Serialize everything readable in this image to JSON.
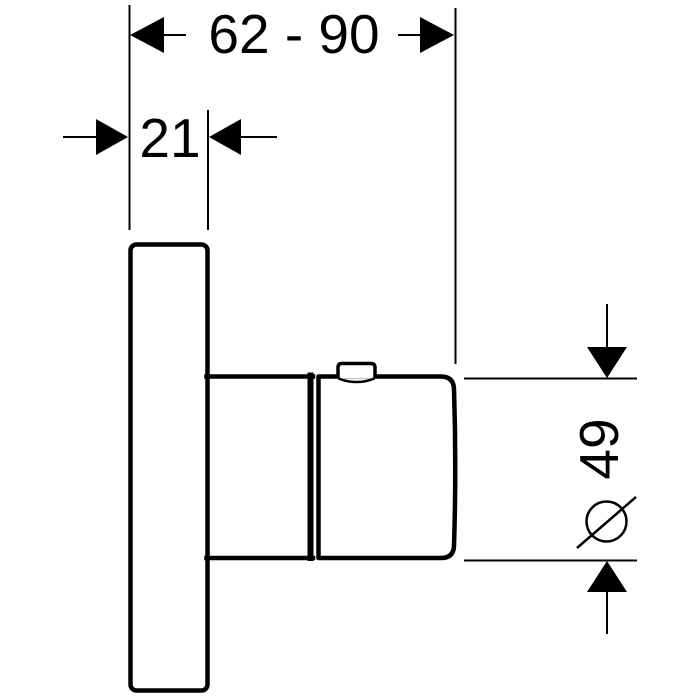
{
  "dimensions": {
    "horizontal_range": "62 - 90",
    "plate_thickness": "21",
    "knob_diameter": "49",
    "diameter_symbol": "ø"
  },
  "colors": {
    "line": "#000000",
    "background": "#ffffff"
  }
}
